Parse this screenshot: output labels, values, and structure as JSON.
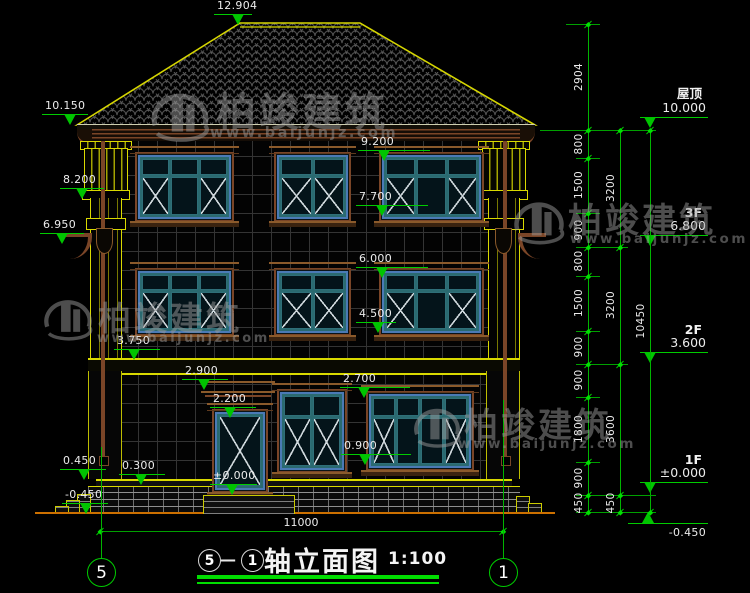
{
  "drawing": {
    "title": {
      "axis_from": "5",
      "axis_to": "1",
      "separator": "—",
      "name": "轴立面图",
      "scale": "1:100"
    },
    "axes": {
      "left": "5",
      "right": "1"
    },
    "watermark": {
      "brand": "柏竣建筑",
      "url": "www.baijunjz.com"
    },
    "floor_levels": {
      "roof": {
        "label": "屋顶",
        "value": "10.000"
      },
      "f3": {
        "label": "3F",
        "value": "6.800"
      },
      "f2": {
        "label": "2F",
        "value": "3.600"
      },
      "f1": {
        "label": "1F",
        "value": "±0.000"
      },
      "grade": {
        "value": "-0.450"
      }
    },
    "markers": {
      "ridge": "12.904",
      "eave": "10.150",
      "capital": "8.200",
      "corbel": "6.950",
      "w3_head": "9.200",
      "w3_sill": "7.700",
      "w2_head": "6.000",
      "w2_sill": "4.500",
      "band": "3.750",
      "canopy": "2.900",
      "w1_head": "2.700",
      "w1_sill": "0.900",
      "door_head": "2.200",
      "door_zero": "±0.000",
      "ledge": "0.450",
      "plinth": "0.300",
      "grade_left": "-0.450"
    },
    "dims": {
      "col1": [
        "2904",
        "800",
        "1500",
        "900",
        "800",
        "1500",
        "900",
        "900",
        "1800",
        "900",
        "450"
      ],
      "col2": [
        "3200",
        "3200",
        "3600",
        "450"
      ],
      "col3": [
        "10450"
      ],
      "bottom": [
        "11000"
      ]
    }
  }
}
